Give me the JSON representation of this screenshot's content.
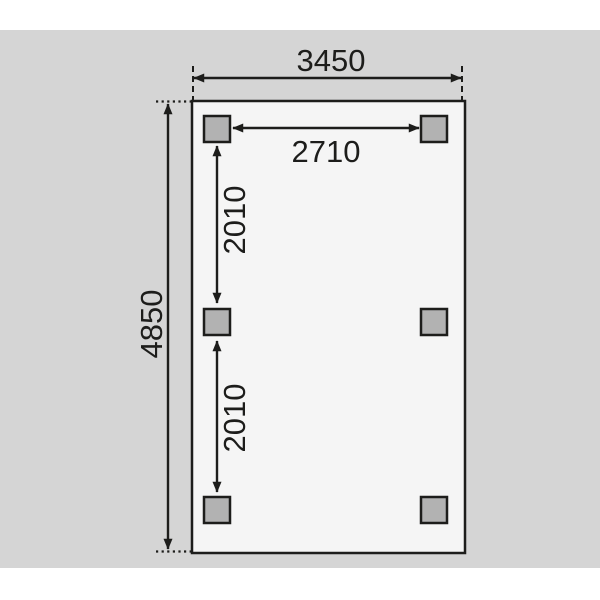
{
  "diagram": {
    "kind": "dimension-plan-top-view",
    "dimension_labels": {
      "overall_width": "3450",
      "overall_depth": "4850",
      "post_span_width": "2710",
      "post_span_depth_upper": "2010",
      "post_span_depth_lower": "2010"
    },
    "posts": {
      "count": 6,
      "shape": "square",
      "layout": "2 columns x 3 rows"
    },
    "colors": {
      "canvas_gray": "#d5d5d5",
      "plan_fill": "#f5f5f5",
      "post_fill": "#b2b2b2",
      "line": "#1d1d1b"
    }
  }
}
